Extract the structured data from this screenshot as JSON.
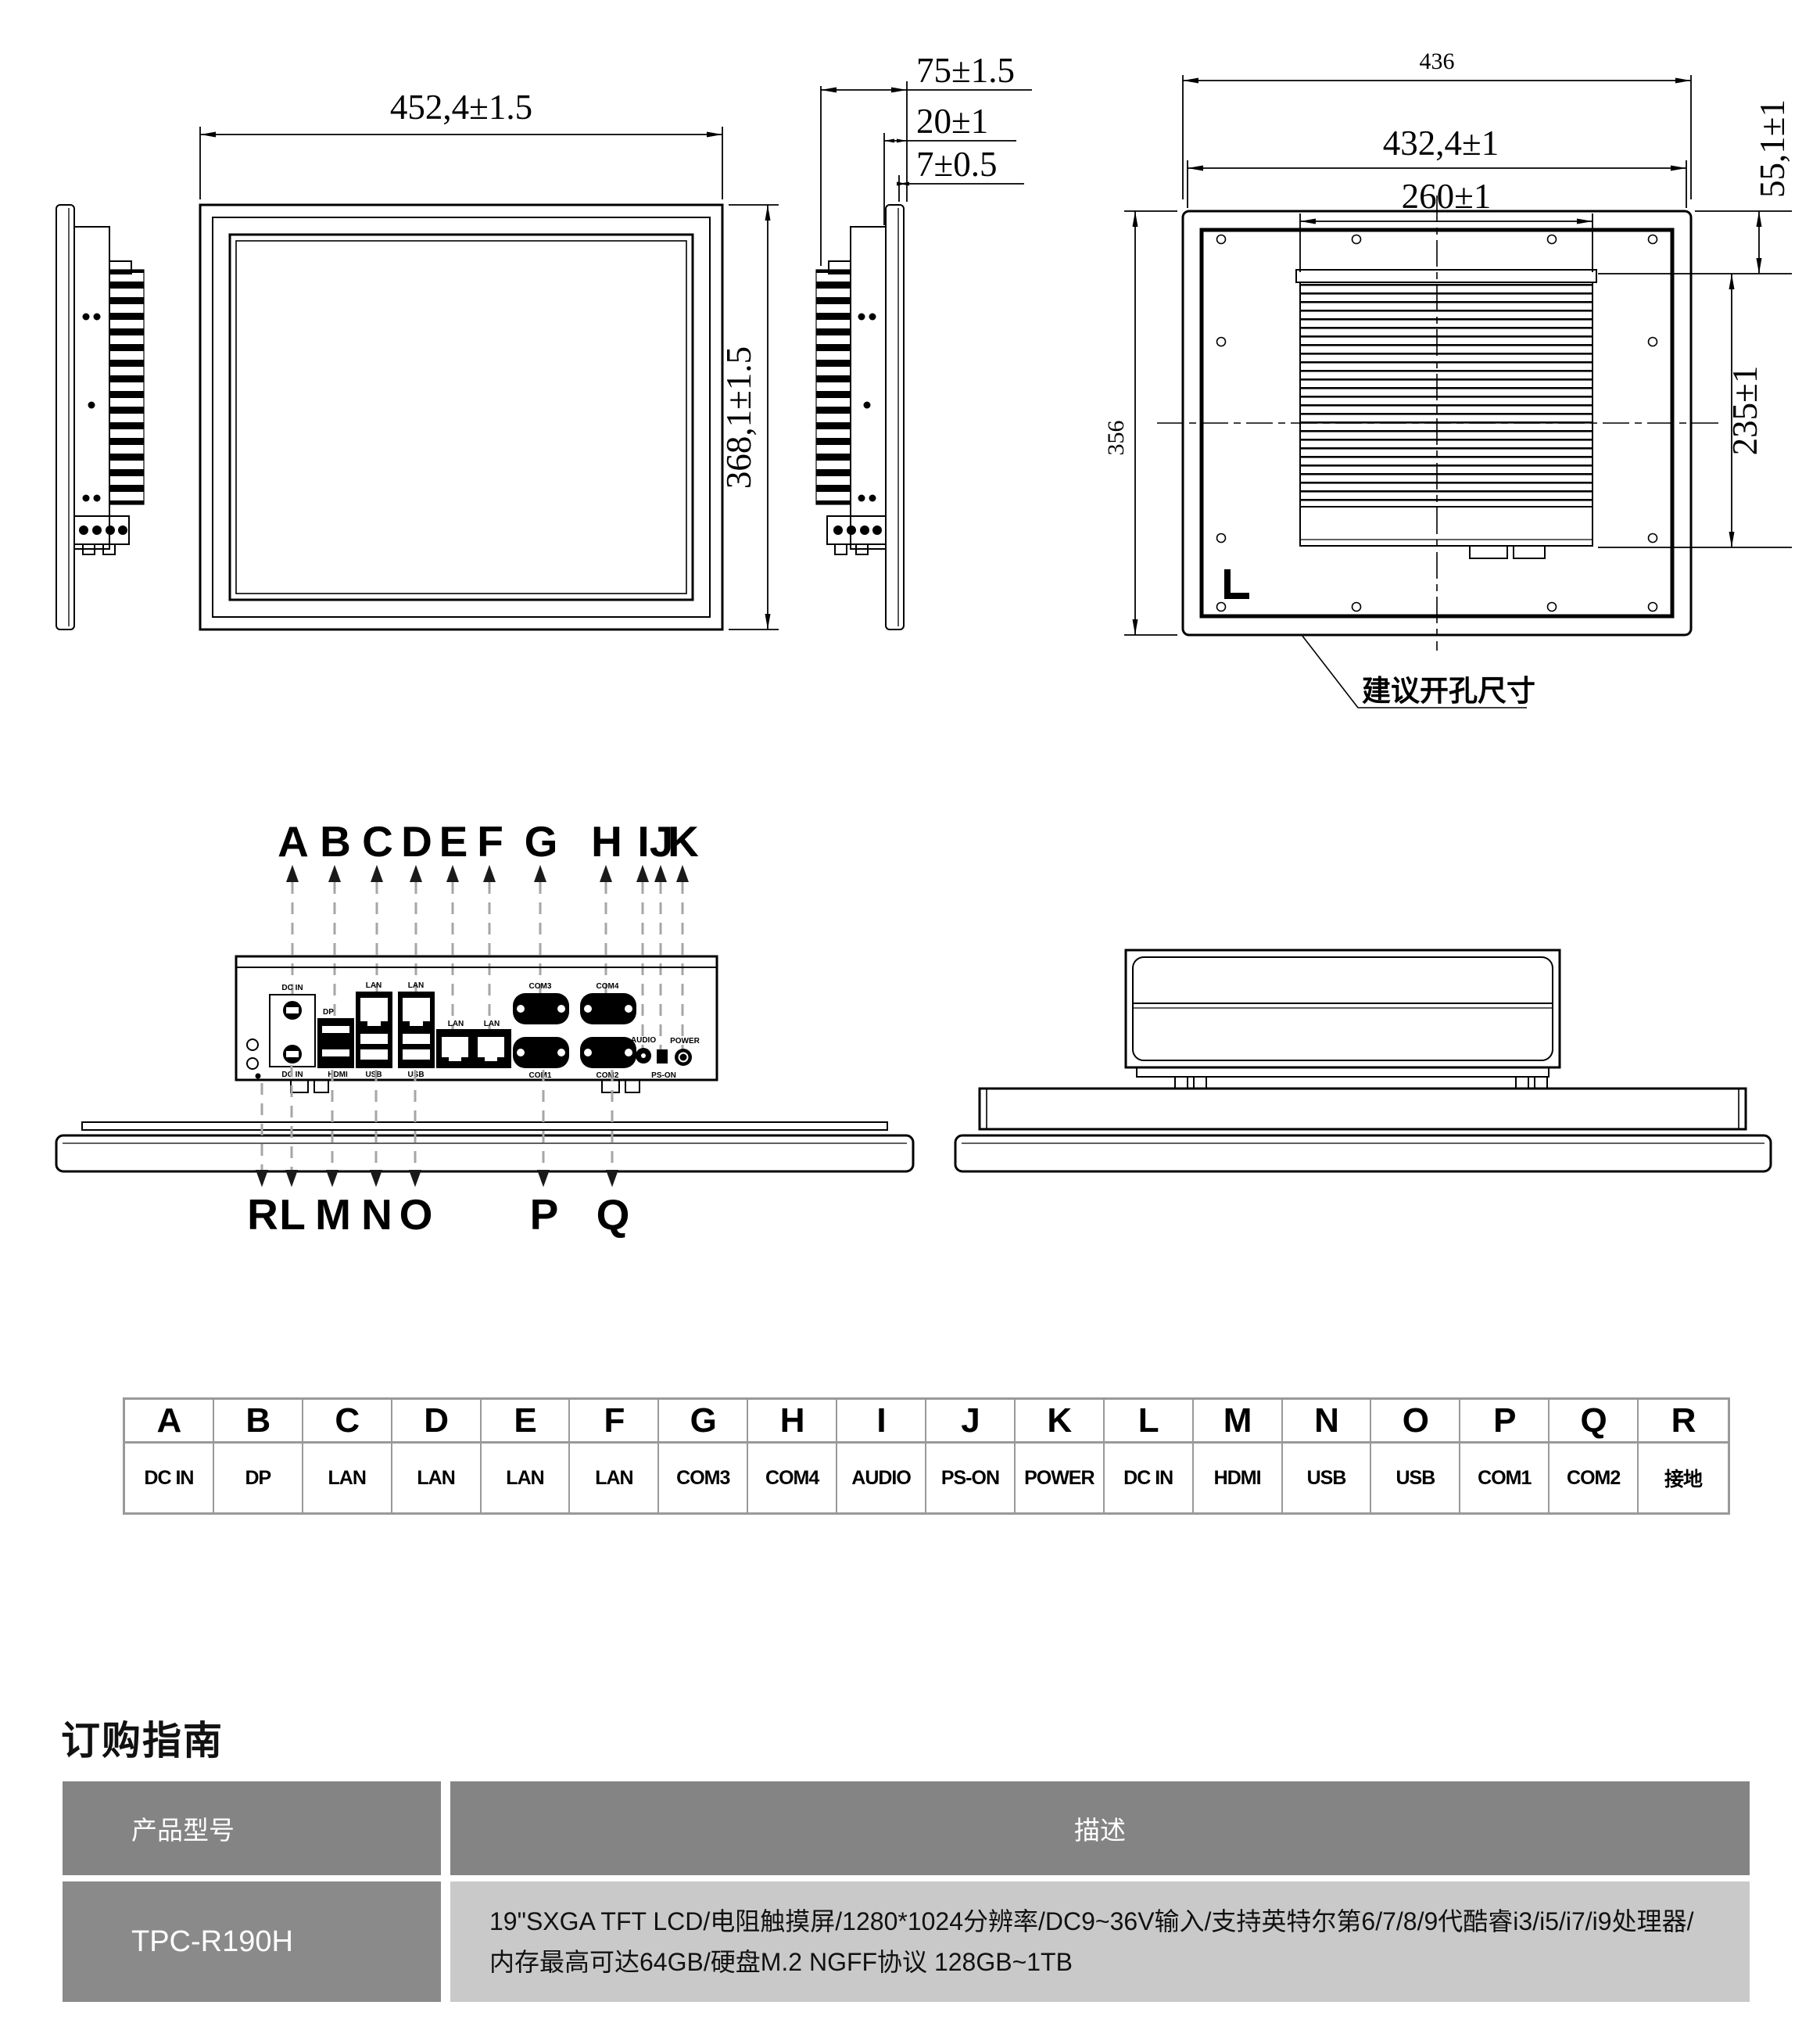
{
  "dims": {
    "front_width": "452,4±1.5",
    "front_height": "368,1±1.5",
    "side_total": "75±1.5",
    "side_module": "20±1",
    "side_panel": "7±0.5",
    "rear_outer_width": "436",
    "rear_body_width": "432,4±1",
    "rear_heatsink_width": "260±1",
    "rear_top_offset": "55,1±1",
    "rear_outer_height": "356",
    "rear_heatsink_height": "235±1",
    "cutout_note": "建议开孔尺寸"
  },
  "io": {
    "top": [
      "A",
      "B",
      "C",
      "D",
      "E",
      "F",
      "G",
      "H",
      "I",
      "J",
      "K"
    ],
    "bottom": [
      "R",
      "L",
      "M",
      "N",
      "O",
      "P",
      "Q"
    ]
  },
  "silk": {
    "dc_in": "DC IN",
    "dp": "DP",
    "hdmi": "HDMI",
    "lan": "LAN",
    "usb": "USB",
    "com1": "COM1",
    "com2": "COM2",
    "com3": "COM3",
    "com4": "COM4",
    "audio": "AUDIO",
    "ps_on": "PS-ON",
    "power": "POWER"
  },
  "ports": {
    "items": [
      {
        "letter": "A",
        "name": "DC IN"
      },
      {
        "letter": "B",
        "name": "DP"
      },
      {
        "letter": "C",
        "name": "LAN"
      },
      {
        "letter": "D",
        "name": "LAN"
      },
      {
        "letter": "E",
        "name": "LAN"
      },
      {
        "letter": "F",
        "name": "LAN"
      },
      {
        "letter": "G",
        "name": "COM3"
      },
      {
        "letter": "H",
        "name": "COM4"
      },
      {
        "letter": "I",
        "name": "AUDIO"
      },
      {
        "letter": "J",
        "name": "PS-ON"
      },
      {
        "letter": "K",
        "name": "POWER"
      },
      {
        "letter": "L",
        "name": "DC IN"
      },
      {
        "letter": "M",
        "name": "HDMI"
      },
      {
        "letter": "N",
        "name": "USB"
      },
      {
        "letter": "O",
        "name": "USB"
      },
      {
        "letter": "P",
        "name": "COM1"
      },
      {
        "letter": "Q",
        "name": "COM2"
      },
      {
        "letter": "R",
        "name": "接地"
      }
    ]
  },
  "ordering": {
    "title": "订购指南",
    "col_model": "产品型号",
    "col_desc": "描述",
    "model": "TPC-R190H",
    "desc_line1": "19\"SXGA TFT LCD/电阻触摸屏/1280*1024分辨率/DC9~36V输入/支持英特尔第6/7/8/9代酷睿i3/i5/i7/i9处理器/",
    "desc_line2": "内存最高可达64GB/硬盘M.2 NGFF协议 128GB~1TB"
  },
  "colors": {
    "header_bg": "#848484",
    "model_bg": "#8a8a8a",
    "desc_bg": "#c9c9c9",
    "table_border": "#999999",
    "leader_gray": "#a6a6a6",
    "line_black": "#000000"
  }
}
